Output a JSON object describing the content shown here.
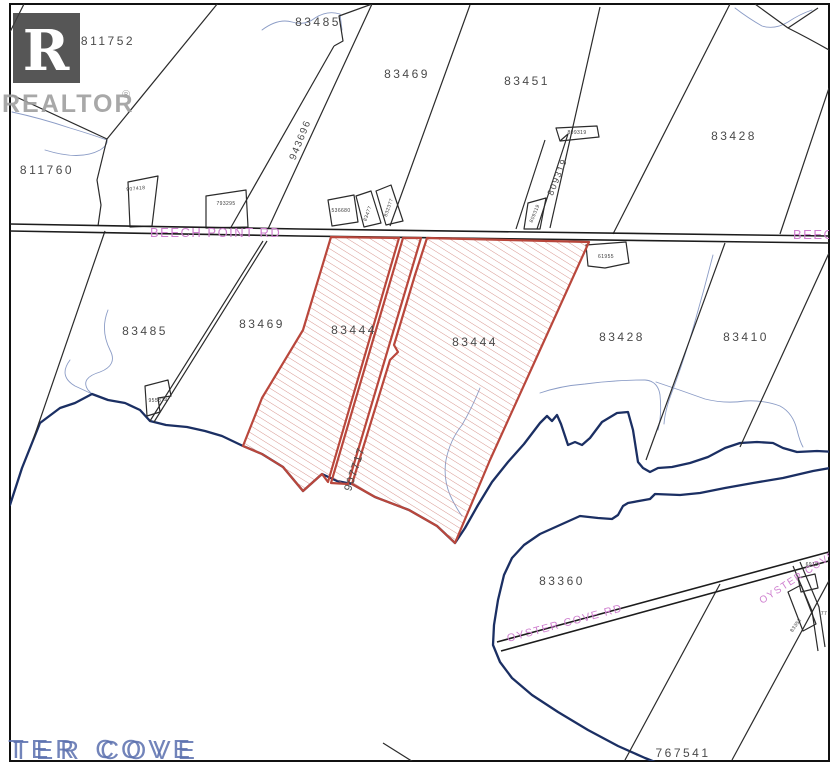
{
  "branding": {
    "logo_letter": "R",
    "name": "REALTOR",
    "registered_mark": "®"
  },
  "roads": {
    "beech_point": "BEECH POINT RD",
    "oyster_cove": "OYSTER COVE RD"
  },
  "water": {
    "cove_label": "TER COVE"
  },
  "parcels": {
    "p811752": "811752",
    "p83485_top": "83485",
    "p83469_top": "83469",
    "p83451": "83451",
    "p83428_top": "83428",
    "p811760": "811760",
    "p943696": "943696",
    "p907418": "907418",
    "p793295": "793295",
    "p536680": "536680",
    "p83477": "83477",
    "p832377": "832377",
    "p809319_strip": "809319",
    "p809319_small_top": "809319",
    "p809319_small_bottom": "809319",
    "p61955": "61955",
    "p83485_mid": "83485",
    "p83469_mid": "83469",
    "p83444_left": "83444",
    "p83444_right": "83444",
    "p907717": "907717",
    "p83428_mid": "83428",
    "p83410": "83410",
    "p955874": "955874",
    "p83360": "83360",
    "p767541": "767541",
    "p6918": "6918",
    "p83352": "83352",
    "p77": "77"
  },
  "colors": {
    "parcel_line": "#2b2b2b",
    "highlight_red": "#b9473c",
    "water_dark": "#1b2f63",
    "water_light": "#8b9cc6",
    "road_label_pink": "#cf7fcf",
    "label_gray": "#4a4a4a"
  }
}
